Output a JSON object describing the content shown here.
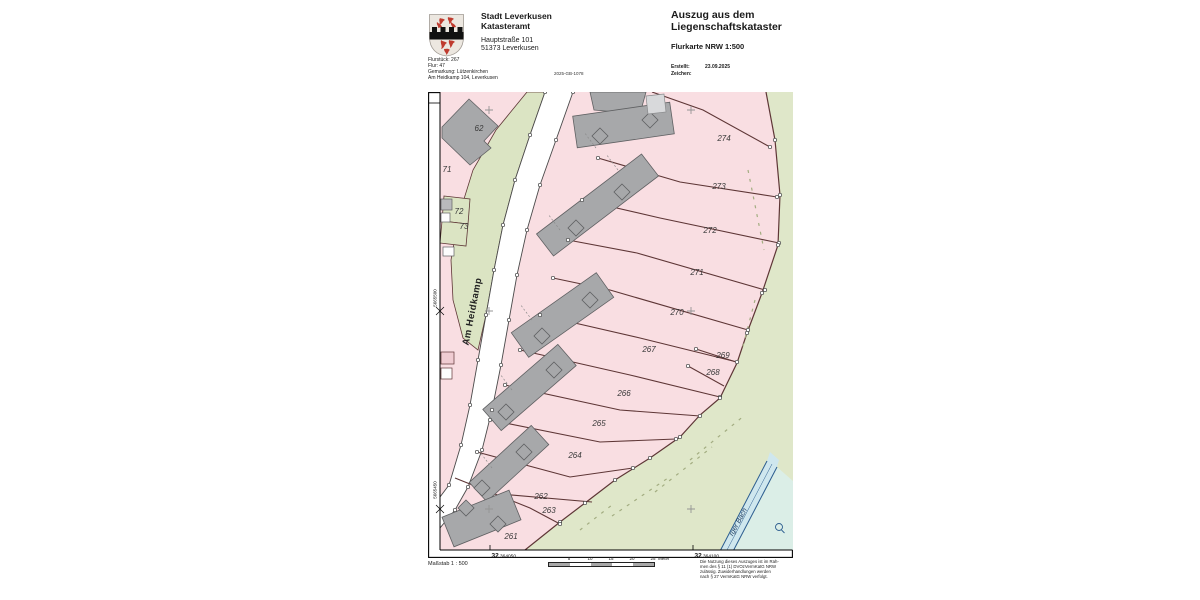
{
  "header": {
    "office_name_line1": "Stadt Leverkusen",
    "office_name_line2": "Katasteramt",
    "address_line1": "Hauptstraße 101",
    "address_line2": "51373 Leverkusen",
    "title_line1": "Auszug aus dem",
    "title_line2": "Liegenschaftskataster",
    "subtitle": "Flurkarte NRW 1:500",
    "info_lines": {
      "0": "Flurstück: 267",
      "1": "Flur: 47",
      "2": "Gemarkung: Lützenkirchen",
      "3": "Am Heidkamp 104, Leverkusen"
    },
    "document_number": "2025-GB-1078",
    "created_label": "Erstellt:",
    "created_value": "23.09.2025",
    "sign_label": "Zeichen:"
  },
  "map": {
    "street_label": "Am Heidkamp",
    "stream_label": "rger Bach",
    "parcel_labels": [
      {
        "id": "62",
        "x": 479,
        "y": 131
      },
      {
        "id": "71",
        "x": 447,
        "y": 172
      },
      {
        "id": "72",
        "x": 459,
        "y": 214
      },
      {
        "id": "73",
        "x": 464,
        "y": 229
      },
      {
        "id": "274",
        "x": 724,
        "y": 141
      },
      {
        "id": "273",
        "x": 719,
        "y": 189
      },
      {
        "id": "272",
        "x": 710,
        "y": 233
      },
      {
        "id": "271",
        "x": 697,
        "y": 275
      },
      {
        "id": "270",
        "x": 677,
        "y": 315
      },
      {
        "id": "267",
        "x": 649,
        "y": 352
      },
      {
        "id": "269",
        "x": 723,
        "y": 358
      },
      {
        "id": "268",
        "x": 713,
        "y": 375
      },
      {
        "id": "266",
        "x": 624,
        "y": 396
      },
      {
        "id": "265",
        "x": 599,
        "y": 426
      },
      {
        "id": "264",
        "x": 575,
        "y": 458
      },
      {
        "id": "262",
        "x": 541,
        "y": 499
      },
      {
        "id": "263",
        "x": 549,
        "y": 513
      },
      {
        "id": "261",
        "x": 511,
        "y": 539
      }
    ],
    "grid_crosses": [
      [
        489,
        110
      ],
      [
        691,
        110
      ],
      [
        489,
        311
      ],
      [
        691,
        311
      ],
      [
        489,
        509
      ],
      [
        691,
        509
      ]
    ],
    "coords": {
      "bottom": [
        {
          "zone": "32",
          "value": "364050",
          "x": 490
        },
        {
          "zone": "32",
          "value": "364100",
          "x": 693
        }
      ],
      "left": [
        {
          "text": "5665500",
          "y": 298
        },
        {
          "text": "5665450",
          "y": 496
        }
      ]
    }
  },
  "footer": {
    "scale_text": "Maßstab 1 : 500",
    "scalebar_ticks": {
      "0": "5",
      "1": "10",
      "2": "15",
      "3": "20",
      "4": "25"
    },
    "scalebar_unit": "Meter",
    "legal_lines": {
      "0": "Die Nutzung dieses Auszuges ist im Rah-",
      "1": "men des § 11 (1) DVOzVermKatG NRW",
      "2": "zulässig. Zuwiderhandlungen werden",
      "3": "nach § 27 VermKatG NRW verfolgt."
    }
  },
  "colors": {
    "parcel_pink": "#f9dee2",
    "meadow_green": "#dfe7c9",
    "strip_green": "#dbe4c3",
    "building_gray": "#a7a8aa",
    "building_light": "#d8d9db",
    "boundary_maroon": "#5e3636",
    "water_blue": "#2c5d8f",
    "water_fill": "#cfe7ee",
    "crest_red": "#bf3b2f"
  }
}
